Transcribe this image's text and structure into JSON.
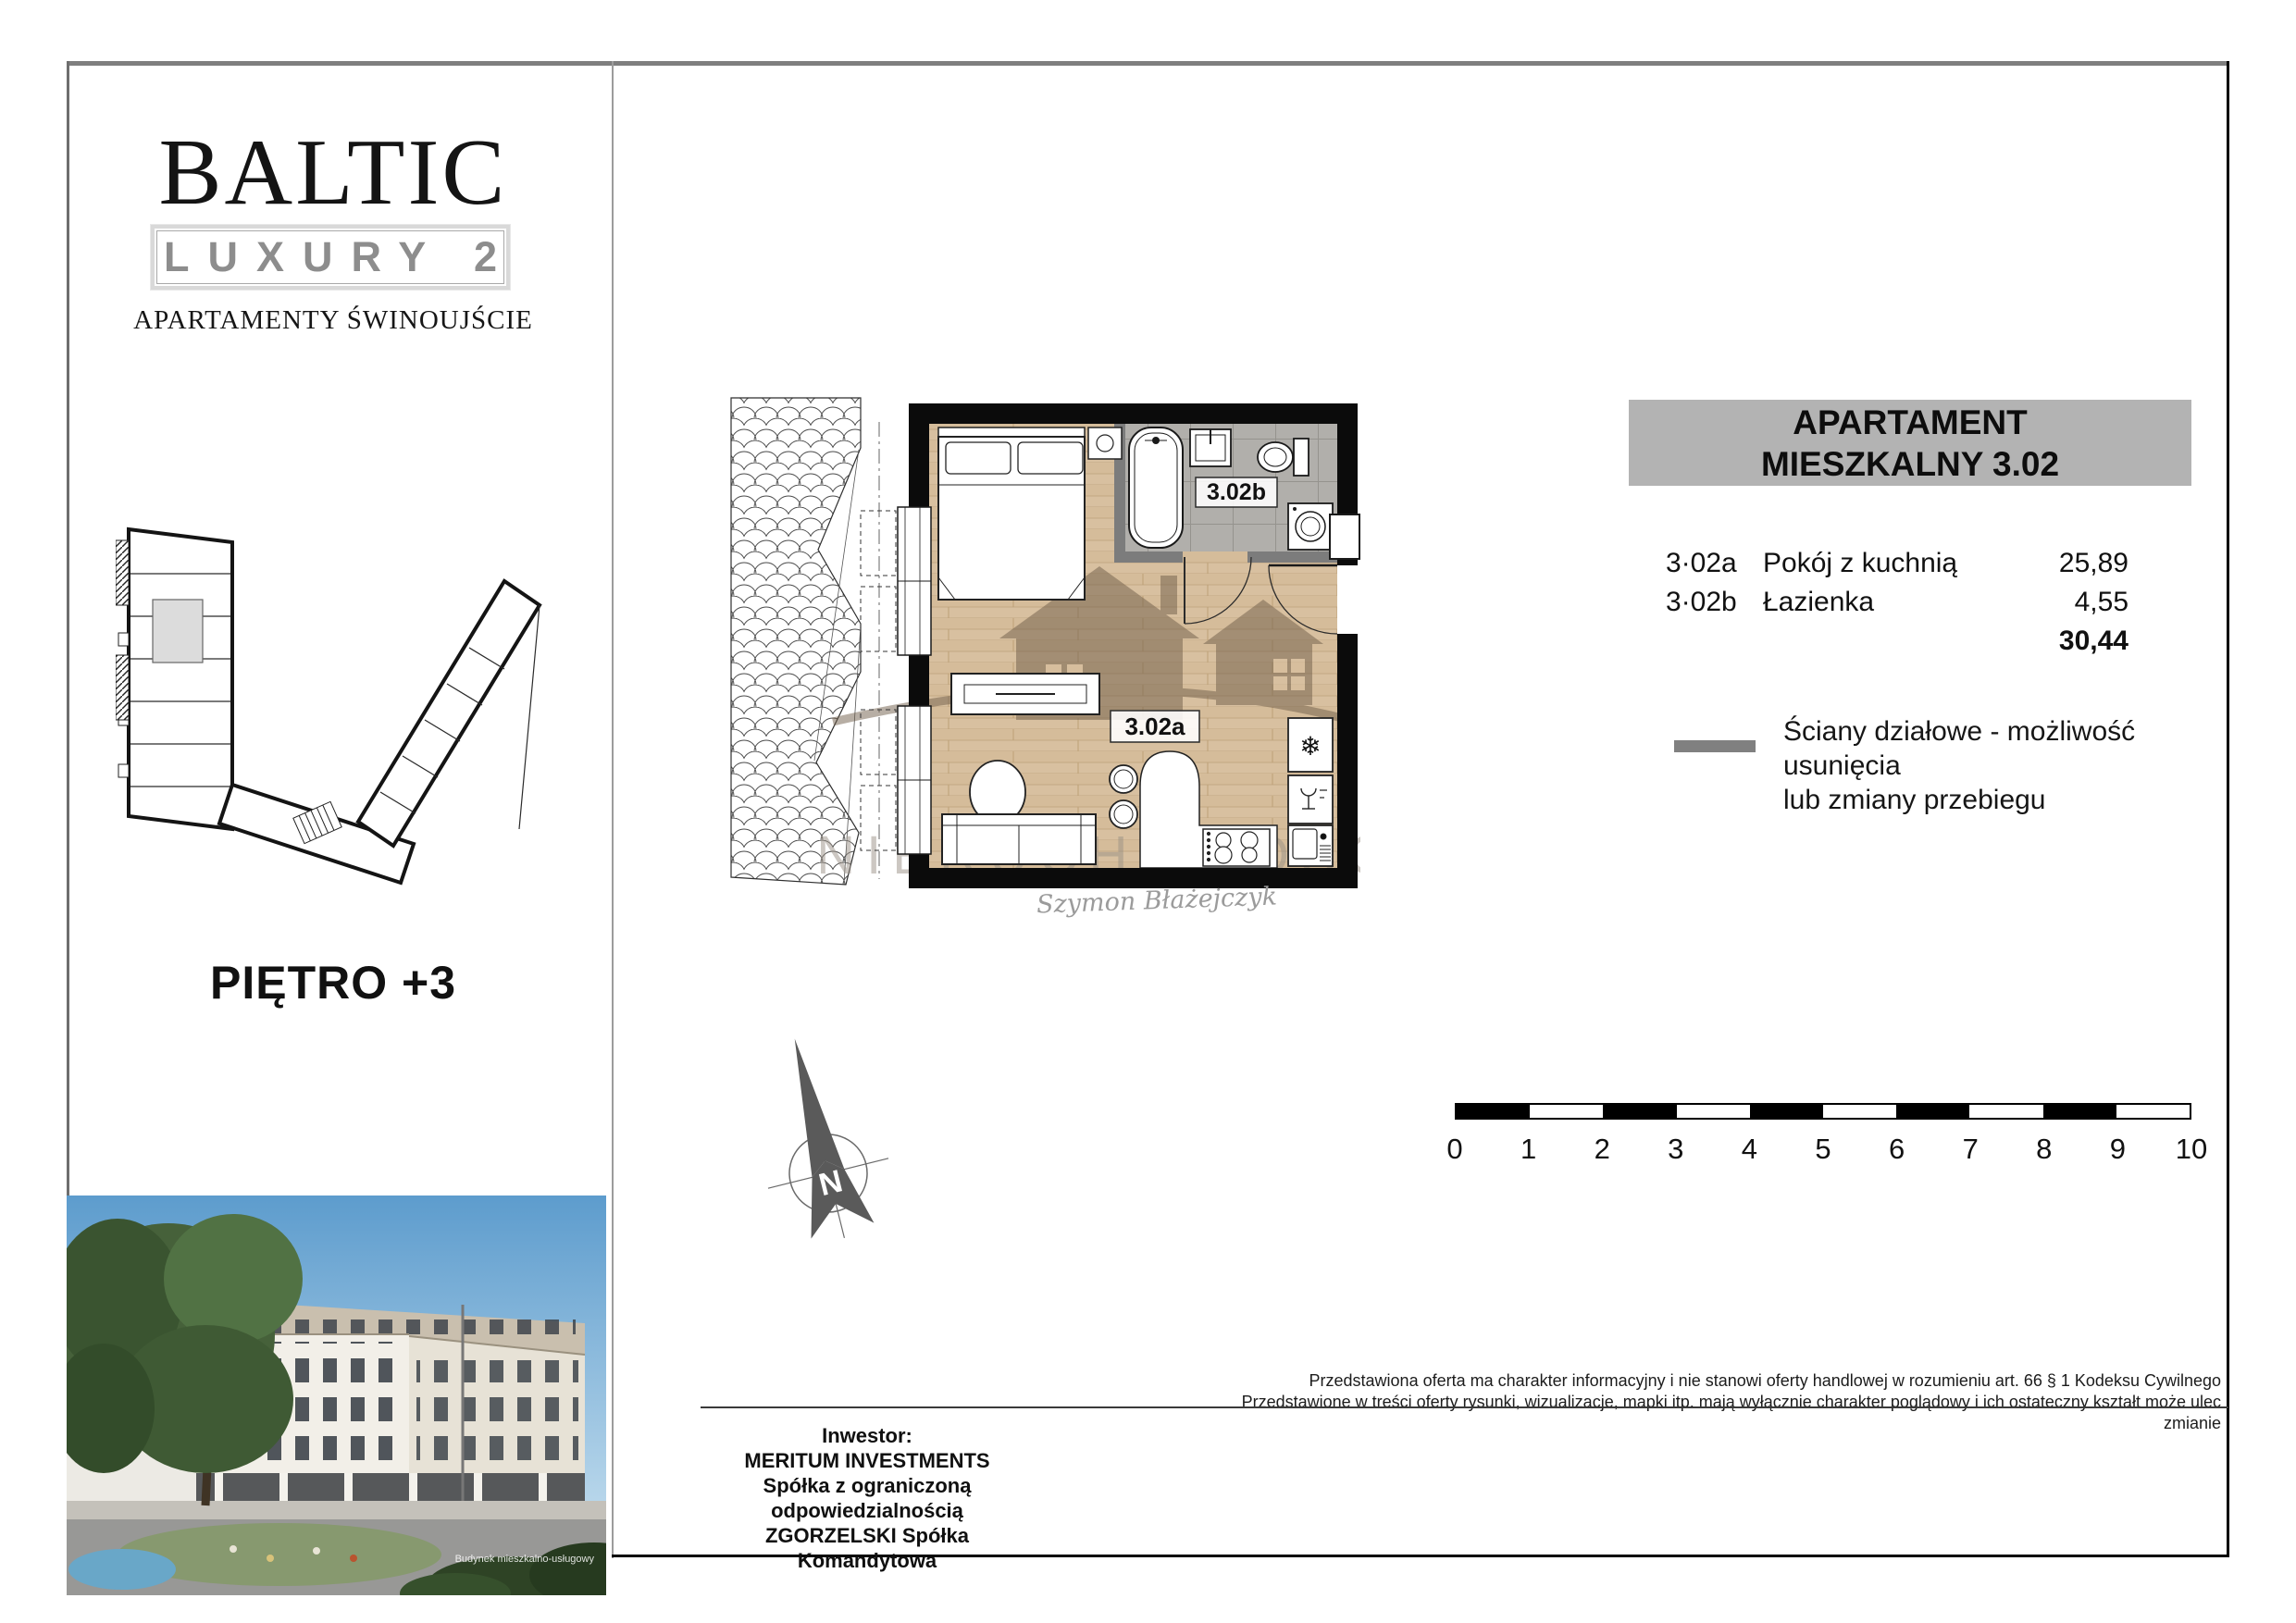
{
  "branding": {
    "title": "BALTIC",
    "subtitle": "LUXURY 2",
    "tagline": "APARTAMENTY ŚWINOUJŚCIE"
  },
  "key_plan": {
    "floor_label": "PIĘTRO +3"
  },
  "floor_plan": {
    "room_a_label": "3.02a",
    "room_b_label": "3.02b",
    "watermark_text": "NIERUCHOMOŚCI",
    "signature": "Szymon Błażejczyk",
    "north_letter": "N"
  },
  "icons": {
    "freezer": "❄"
  },
  "colors": {
    "card_header_bg": "#b3b3b3",
    "legend_swatch": "#808080",
    "wall_black": "#0b0b0b",
    "wood_floor": "#d8c0a0",
    "bathroom_tile": "#b1afab"
  },
  "apartment_card": {
    "title_line1": "APARTAMENT",
    "title_line2": "MIESZKALNY 3.02",
    "rows": [
      {
        "code": "3·02a",
        "name": "Pokój z kuchnią",
        "area": "25,89"
      },
      {
        "code": "3·02b",
        "name": "Łazienka",
        "area": "4,55"
      }
    ],
    "total_area": "30,44"
  },
  "legend": {
    "line1": "Ściany działowe - możliwość usunięcia",
    "line2": "lub zmiany przebiegu"
  },
  "scale_bar": {
    "labels": [
      "0",
      "1",
      "2",
      "3",
      "4",
      "5",
      "6",
      "7",
      "8",
      "9",
      "10"
    ]
  },
  "footer": {
    "disclaimer_line1": "Przedstawiona oferta ma charakter informacyjny i nie stanowi oferty handlowej w rozumieniu art. 66 § 1 Kodeksu Cywilnego",
    "disclaimer_line2": "Przedstawione w treści oferty rysunki, wizualizacje, mapki itp. mają wyłącznie charakter poglądowy i ich ostateczny kształt może ulec zmianie",
    "investor_heading": "Inwestor:",
    "investor_lines": [
      "MERITUM INVESTMENTS",
      "Spółka z ograniczoną odpowiedzialnością",
      "ZGORZELSKI Spółka Komandytowa"
    ]
  },
  "photo": {
    "caption_line1": "Budynek mieszkalno-usługowy"
  }
}
